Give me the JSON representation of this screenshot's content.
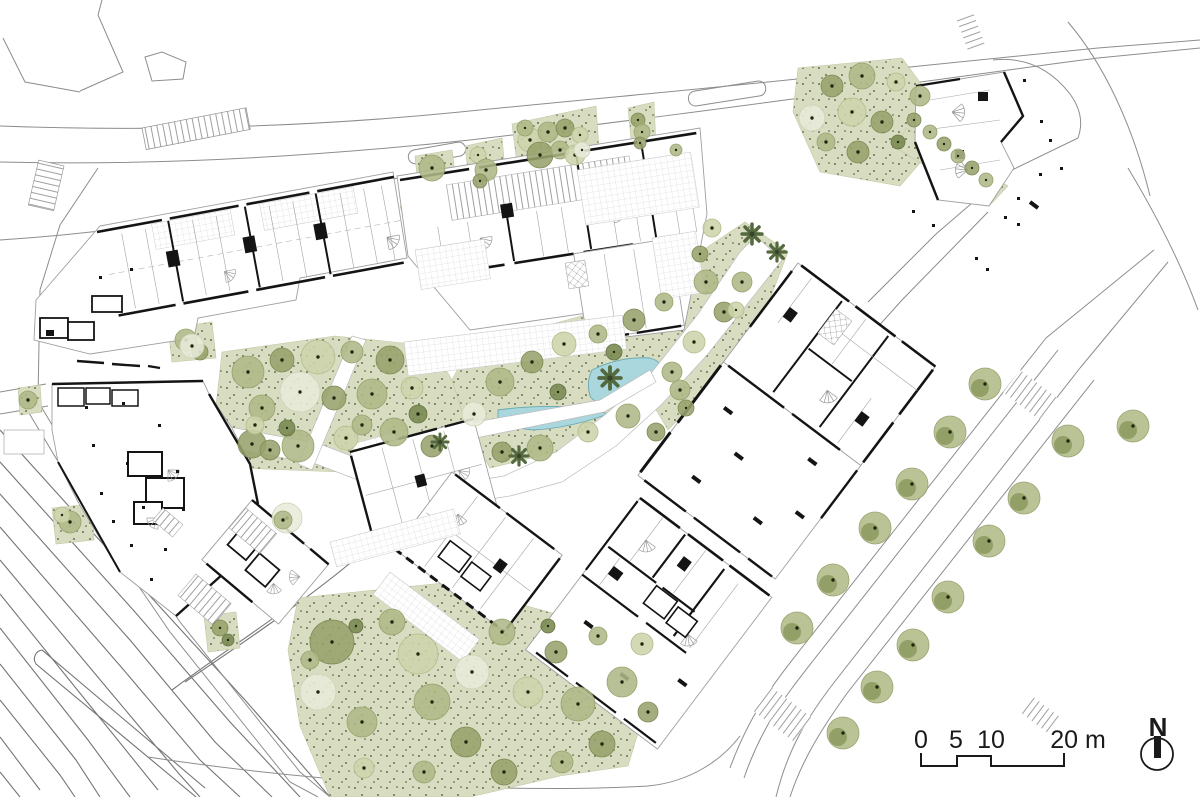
{
  "drawing": {
    "type": "architectural ground-floor site plan",
    "orientation_label": "N",
    "scale_unit": "m"
  },
  "scale_bar": {
    "labels": [
      "0",
      "5",
      "10",
      "20 m"
    ]
  },
  "north": {
    "label": "N"
  },
  "palette": {
    "background": "#ffffff",
    "line_gray": "#8d8d8d",
    "line_light": "#bdbdbd",
    "wall_black": "#141414",
    "green_fill": "#d8ddc2",
    "green_stipple": "#49512f",
    "pond_fill": "#a9d7dd",
    "pond_stroke": "#68a8b2",
    "tree_dot": "#1f270f",
    "tree_shades": {
      "pale": {
        "fill": "#e8ead9",
        "stroke": "#ccd1b4"
      },
      "light": {
        "fill": "#cdd4ab",
        "stroke": "#b2bb8b"
      },
      "med": {
        "fill": "#aeb886",
        "stroke": "#97a26e"
      },
      "dark": {
        "fill": "#96a26b",
        "stroke": "#7e8b55"
      },
      "deep": {
        "fill": "#78884f",
        "stroke": "#657546"
      }
    },
    "street_tree": {
      "fill": "#b3bc8a",
      "inner": "#8b9a60",
      "stroke": "#9aa571"
    },
    "palm_color": "#55693f"
  },
  "landscape": {
    "trees": [
      [
        248,
        372,
        16,
        "med"
      ],
      [
        282,
        360,
        12,
        "dark"
      ],
      [
        318,
        357,
        17,
        "light"
      ],
      [
        352,
        352,
        11,
        "med"
      ],
      [
        390,
        360,
        14,
        "dark"
      ],
      [
        300,
        392,
        20,
        "pale"
      ],
      [
        262,
        408,
        13,
        "med"
      ],
      [
        334,
        398,
        12,
        "dark"
      ],
      [
        372,
        394,
        15,
        "med"
      ],
      [
        412,
        388,
        11,
        "light"
      ],
      [
        252,
        444,
        14,
        "dark"
      ],
      [
        298,
        446,
        16,
        "med"
      ],
      [
        346,
        438,
        12,
        "light"
      ],
      [
        394,
        432,
        14,
        "med"
      ],
      [
        432,
        446,
        11,
        "dark"
      ],
      [
        287,
        428,
        8,
        "deep"
      ],
      [
        418,
        414,
        9,
        "deep"
      ],
      [
        362,
        425,
        10,
        "med"
      ],
      [
        255,
        425,
        9,
        "light"
      ],
      [
        270,
        450,
        10,
        "dark"
      ],
      [
        500,
        382,
        14,
        "med"
      ],
      [
        532,
        362,
        11,
        "dark"
      ],
      [
        564,
        344,
        12,
        "light"
      ],
      [
        598,
        334,
        9,
        "med"
      ],
      [
        634,
        320,
        11,
        "dark"
      ],
      [
        664,
        302,
        9,
        "med"
      ],
      [
        558,
        392,
        8,
        "deep"
      ],
      [
        628,
        416,
        12,
        "med"
      ],
      [
        588,
        432,
        10,
        "light"
      ],
      [
        540,
        448,
        13,
        "med"
      ],
      [
        502,
        452,
        10,
        "dark"
      ],
      [
        474,
        414,
        12,
        "pale"
      ],
      [
        656,
        432,
        9,
        "dark"
      ],
      [
        680,
        390,
        10,
        "med"
      ],
      [
        614,
        352,
        8,
        "deep"
      ],
      [
        706,
        282,
        12,
        "med"
      ],
      [
        724,
        312,
        10,
        "dark"
      ],
      [
        694,
        342,
        11,
        "light"
      ],
      [
        672,
        372,
        10,
        "med"
      ],
      [
        700,
        254,
        8,
        "dark"
      ],
      [
        742,
        282,
        10,
        "med"
      ],
      [
        686,
        408,
        8,
        "dark"
      ],
      [
        712,
        228,
        9,
        "light"
      ],
      [
        736,
        310,
        8,
        "light"
      ],
      [
        832,
        86,
        11,
        "dark"
      ],
      [
        862,
        76,
        13,
        "med"
      ],
      [
        896,
        82,
        9,
        "light"
      ],
      [
        920,
        96,
        10,
        "med"
      ],
      [
        852,
        112,
        14,
        "light"
      ],
      [
        882,
        122,
        11,
        "dark"
      ],
      [
        826,
        142,
        9,
        "med"
      ],
      [
        858,
        152,
        11,
        "dark"
      ],
      [
        898,
        142,
        7,
        "deep"
      ],
      [
        812,
        118,
        13,
        "pale"
      ],
      [
        930,
        132,
        7,
        "med"
      ],
      [
        944,
        144,
        7,
        "dark"
      ],
      [
        958,
        156,
        7,
        "med"
      ],
      [
        972,
        168,
        7,
        "dark"
      ],
      [
        986,
        180,
        7,
        "med"
      ],
      [
        914,
        120,
        7,
        "dark"
      ],
      [
        332,
        642,
        22,
        "dark"
      ],
      [
        318,
        692,
        18,
        "pale"
      ],
      [
        362,
        722,
        15,
        "med"
      ],
      [
        392,
        622,
        13,
        "med"
      ],
      [
        418,
        654,
        20,
        "light"
      ],
      [
        432,
        702,
        18,
        "med"
      ],
      [
        466,
        742,
        15,
        "dark"
      ],
      [
        472,
        672,
        17,
        "pale"
      ],
      [
        502,
        632,
        13,
        "med"
      ],
      [
        528,
        692,
        15,
        "light"
      ],
      [
        556,
        652,
        11,
        "dark"
      ],
      [
        578,
        704,
        17,
        "med"
      ],
      [
        602,
        744,
        13,
        "dark"
      ],
      [
        622,
        682,
        15,
        "med"
      ],
      [
        642,
        644,
        11,
        "light"
      ],
      [
        562,
        762,
        11,
        "med"
      ],
      [
        504,
        772,
        13,
        "dark"
      ],
      [
        424,
        772,
        11,
        "med"
      ],
      [
        364,
        768,
        10,
        "light"
      ],
      [
        356,
        626,
        7,
        "deep"
      ],
      [
        548,
        626,
        7,
        "deep"
      ],
      [
        598,
        636,
        9,
        "med"
      ],
      [
        648,
        712,
        10,
        "dark"
      ],
      [
        310,
        660,
        9,
        "med"
      ],
      [
        432,
        168,
        13,
        "med"
      ],
      [
        478,
        155,
        8,
        "light"
      ],
      [
        486,
        170,
        11,
        "med"
      ],
      [
        480,
        181,
        7,
        "dark"
      ],
      [
        530,
        140,
        12,
        "light"
      ],
      [
        548,
        132,
        10,
        "med"
      ],
      [
        565,
        128,
        9,
        "dark"
      ],
      [
        580,
        135,
        8,
        "light"
      ],
      [
        540,
        155,
        13,
        "dark"
      ],
      [
        560,
        150,
        9,
        "med"
      ],
      [
        575,
        155,
        10,
        "light"
      ],
      [
        525,
        128,
        8,
        "med"
      ],
      [
        582,
        150,
        8,
        "pale"
      ],
      [
        638,
        120,
        7,
        "dark"
      ],
      [
        642,
        132,
        8,
        "med"
      ],
      [
        640,
        143,
        6,
        "dark"
      ],
      [
        676,
        150,
        6,
        "med"
      ],
      [
        186,
        340,
        11,
        "med"
      ],
      [
        200,
        352,
        8,
        "dark"
      ],
      [
        192,
        346,
        12,
        "pale"
      ],
      [
        28,
        400,
        9,
        "med"
      ],
      [
        70,
        522,
        11,
        "med"
      ],
      [
        62,
        515,
        8,
        "light"
      ],
      [
        220,
        628,
        8,
        "dark"
      ],
      [
        228,
        640,
        6,
        "deep"
      ],
      [
        287,
        518,
        15,
        "pale"
      ],
      [
        283,
        520,
        9,
        "med"
      ]
    ],
    "street_trees": [
      [
        797,
        628
      ],
      [
        833,
        580
      ],
      [
        875,
        528
      ],
      [
        912,
        484
      ],
      [
        950,
        432
      ],
      [
        985,
        384
      ],
      [
        877,
        687
      ],
      [
        913,
        645
      ],
      [
        948,
        597
      ],
      [
        989,
        541
      ],
      [
        1024,
        498
      ],
      [
        1068,
        441
      ],
      [
        1133,
        426
      ],
      [
        843,
        733
      ]
    ],
    "palms": [
      [
        752,
        234,
        1.1
      ],
      [
        777,
        252,
        1.0
      ],
      [
        610,
        378,
        1.2
      ],
      [
        519,
        456,
        1.0
      ],
      [
        440,
        442,
        0.9
      ]
    ]
  }
}
